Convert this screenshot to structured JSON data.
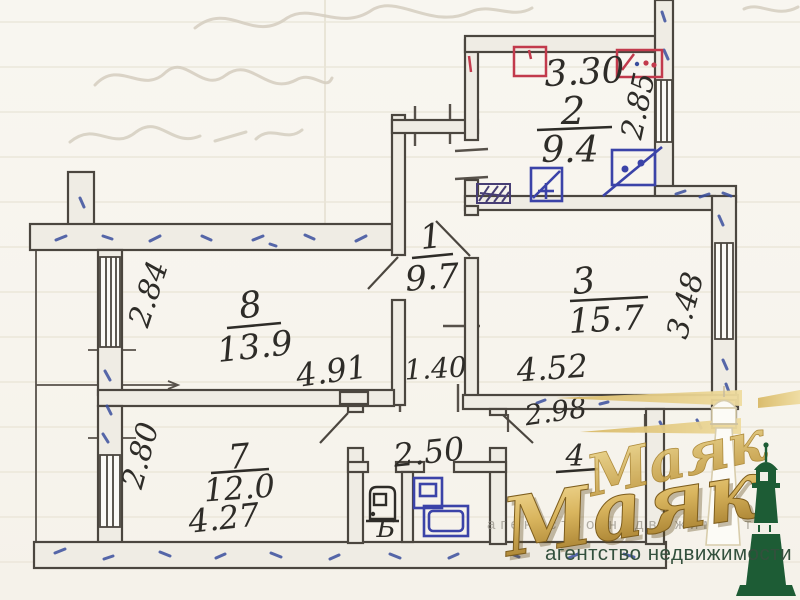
{
  "plan": {
    "rooms": {
      "kitchen": {
        "number": "2",
        "area": "9.4"
      },
      "hall": {
        "number": "1",
        "area": "9.7"
      },
      "room3": {
        "number": "3",
        "area": "15.7"
      },
      "room8": {
        "number": "8",
        "area": "13.9"
      },
      "room7": {
        "number": "7",
        "area": "12.0"
      },
      "room4": {
        "number": "4"
      },
      "toilet": {
        "label": "Б"
      }
    },
    "dimensions": {
      "kitchen_width": "3.30",
      "kitchen_depth": "2.85",
      "room8_depth": "2.84",
      "room8_width": "4.91",
      "hall_width": "1.40",
      "room3_width": "4.52",
      "room3_depth": "3.48",
      "room7_depth": "2.80",
      "room7_width": "4.27",
      "corridor_width": "2.50",
      "room4_width": "2.98"
    }
  },
  "watermark": {
    "brand": "Маяк",
    "tagline": "агентство недвижимости",
    "colors": {
      "gold": "#c9a23c",
      "gold_light": "#ecd48e",
      "green": "#1d5c35",
      "ink": "#2e2c28",
      "pen_blue": "#3a4f9e",
      "pen_red": "#c23a4c"
    }
  }
}
